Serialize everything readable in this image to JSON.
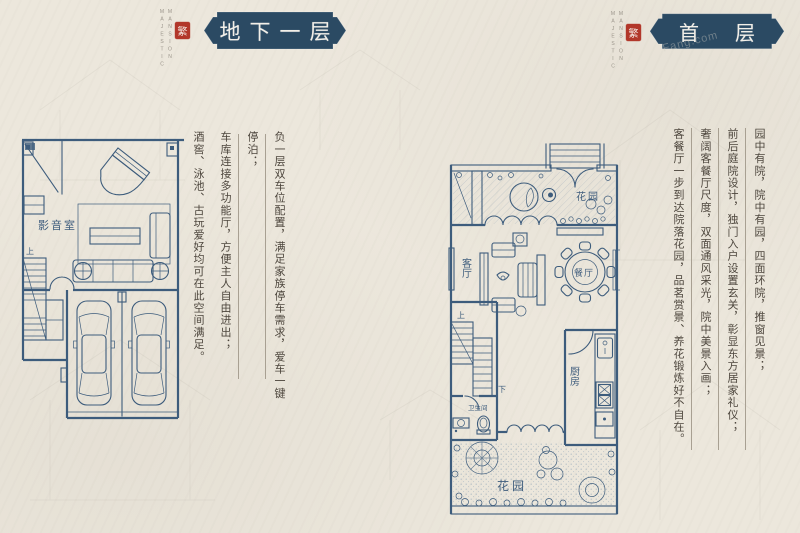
{
  "brand": {
    "word1": "MAJESTIC",
    "word2": "MANSION",
    "seal": "繁"
  },
  "watermark": "Fang.com",
  "sections": {
    "basement": {
      "title": "地下一层",
      "paragraphs": [
        "负一层双车位配置，满足家族停车需求，爱车一键停泊；",
        "车库连接多功能厅，方便主人自由进出；",
        "酒窖、泳池、古玩爱好均可在此空间满足。"
      ],
      "plan_labels": {
        "theater": "影音室",
        "up": "上"
      }
    },
    "first_floor": {
      "title": "首层",
      "paragraphs": [
        "园中有院，院中有园，四面环院，推窗见景；",
        "前后庭院设计，独门入户设置玄关，彰显东方居家礼仪；",
        "奢阔客餐厅尺度，双面通风采光，院中美景入画；",
        "客餐厅一步到达院落花园，品茗赏景、养花锻炼好不自在。"
      ],
      "plan_labels": {
        "garden_top": "花园",
        "living": "客厅",
        "dining": "餐厅",
        "kitchen": "厨房",
        "bath": "卫生间",
        "garden_bottom": "花园",
        "up": "上",
        "down": "下"
      }
    }
  },
  "colors": {
    "background": "#ece7dc",
    "banner": "#2b4a63",
    "plan_line": "#3d5c7c",
    "seal_red": "#b2372a",
    "text": "#4d463d"
  }
}
